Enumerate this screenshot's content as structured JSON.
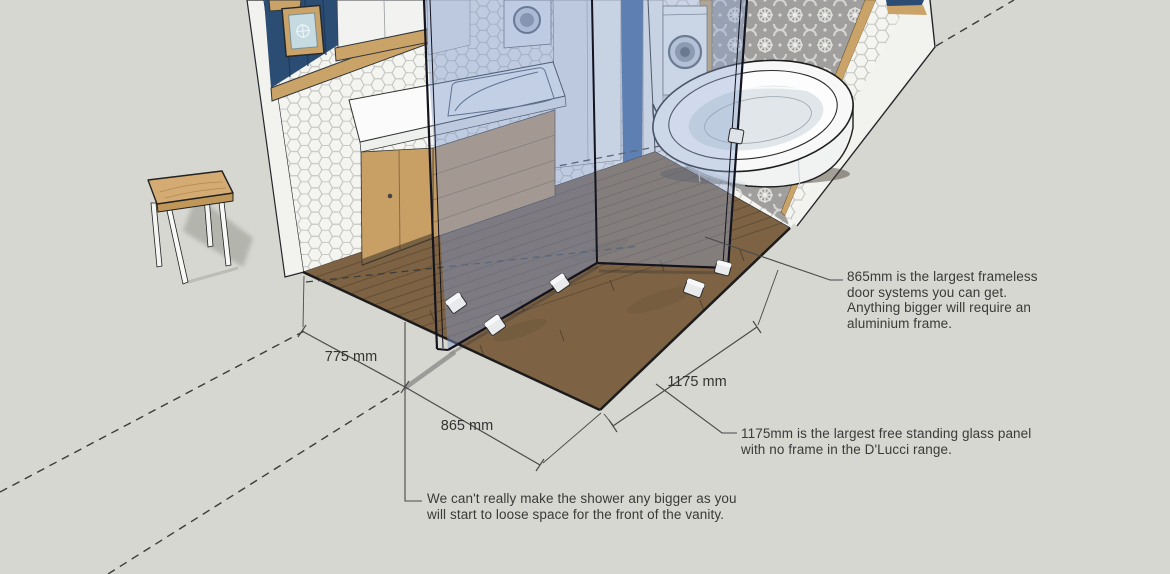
{
  "canvas": {
    "width": 1170,
    "height": 574
  },
  "colors": {
    "background": "#d6d7d1",
    "wall_paint_blue": "#2b4d73",
    "timber_trim": "#c9a368",
    "floor_timber": "#7d6344",
    "vanity_timber": "#c8a066",
    "glass_tint_left": "rgba(126,153,203,0.45)",
    "glass_tint_right": "rgba(139,164,210,0.40)",
    "annotation_line": "#4a4a4a",
    "annotation_text": "#3a3a3a",
    "tile_white": "#f4f4f1",
    "pattern_tile_grey": "#a09f9d"
  },
  "annotations": {
    "dimensions": [
      {
        "id": "dim-775",
        "label": "775 mm"
      },
      {
        "id": "dim-865",
        "label": "865 mm"
      },
      {
        "id": "dim-1175",
        "label": "1175 mm"
      }
    ],
    "notes": [
      {
        "id": "note-frameless-door",
        "lines": [
          "865mm is the largest frameless",
          "door systems you can get.",
          "Anything bigger will require an",
          "aluminium frame."
        ]
      },
      {
        "id": "note-free-standing-panel",
        "lines": [
          "1175mm is the largest free standing glass panel",
          "with no frame in the D'Lucci range."
        ]
      },
      {
        "id": "note-shower-size",
        "lines": [
          "We can't really make the shower any bigger as you",
          "will start to loose space for the front of the vanity."
        ]
      }
    ]
  }
}
